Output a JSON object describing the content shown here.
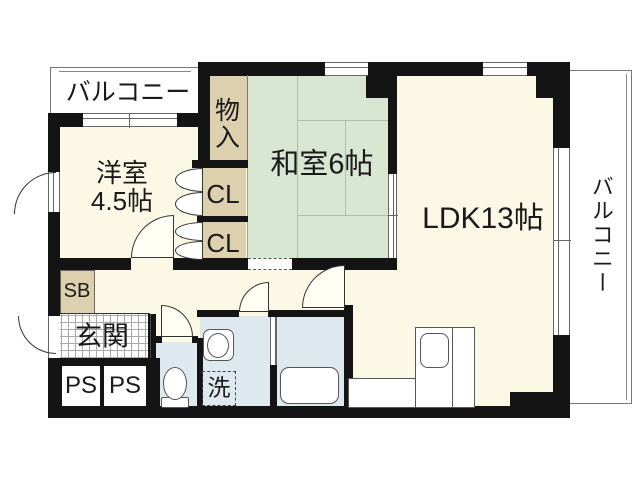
{
  "floorplan": {
    "type": "apartment-floor-plan",
    "labels": {
      "balcony_top": "バルコニー",
      "balcony_right": "バルコニー",
      "storage": "物入",
      "japanese_room": "和室6帖",
      "ldk": "LDK13帖",
      "western_room": "洋室\n4.5帖",
      "closet_1": "CL",
      "closet_2": "CL",
      "shoe_box": "SB",
      "entrance": "玄関",
      "pipe_space_1": "PS",
      "pipe_space_2": "PS",
      "laundry": "洗"
    },
    "rooms": [
      {
        "name": "balcony-top",
        "label": "バルコニー"
      },
      {
        "name": "western-room",
        "label": "洋室4.5帖",
        "size_tatami": 4.5
      },
      {
        "name": "storage",
        "label": "物入"
      },
      {
        "name": "japanese-room",
        "label": "和室6帖",
        "size_tatami": 6
      },
      {
        "name": "ldk",
        "label": "LDK13帖",
        "size_tatami": 13
      },
      {
        "name": "closet-1",
        "label": "CL"
      },
      {
        "name": "closet-2",
        "label": "CL"
      },
      {
        "name": "shoe-box",
        "label": "SB"
      },
      {
        "name": "entrance",
        "label": "玄関"
      },
      {
        "name": "pipe-space-1",
        "label": "PS"
      },
      {
        "name": "pipe-space-2",
        "label": "PS"
      },
      {
        "name": "toilet",
        "label": ""
      },
      {
        "name": "washroom",
        "label": "洗"
      },
      {
        "name": "bathroom",
        "label": ""
      },
      {
        "name": "balcony-right",
        "label": "バルコニー"
      }
    ],
    "fixture_icons": [
      "toilet-icon",
      "washbasin-icon",
      "washer-pan-icon",
      "bathtub-icon",
      "kitchen-sink-icon"
    ],
    "colors": {
      "wall": "#141414",
      "room_cream": "#fcf8e6",
      "tatami_green": "#d9e6d2",
      "closet_tan": "#ddd0ae",
      "wet_area_blue": "#dde8ef",
      "background": "#ffffff"
    }
  }
}
